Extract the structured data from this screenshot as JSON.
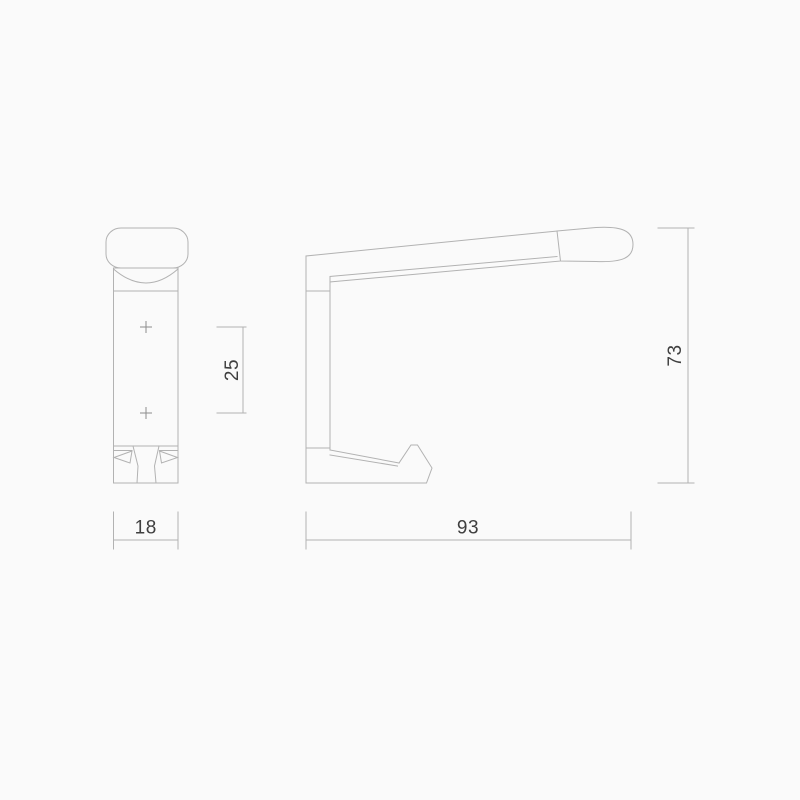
{
  "page": {
    "background_color": "#fafafa"
  },
  "drawing": {
    "line_color": "#b2b2b2",
    "centre_mark_color": "#8c8c8c",
    "text_color": "#3f3f3f",
    "views": {
      "front": "front-elevation",
      "side": "side-elevation"
    },
    "dimensions": {
      "front_width": "18",
      "fixing_centres": "25",
      "projection": "93",
      "height": "73"
    }
  }
}
